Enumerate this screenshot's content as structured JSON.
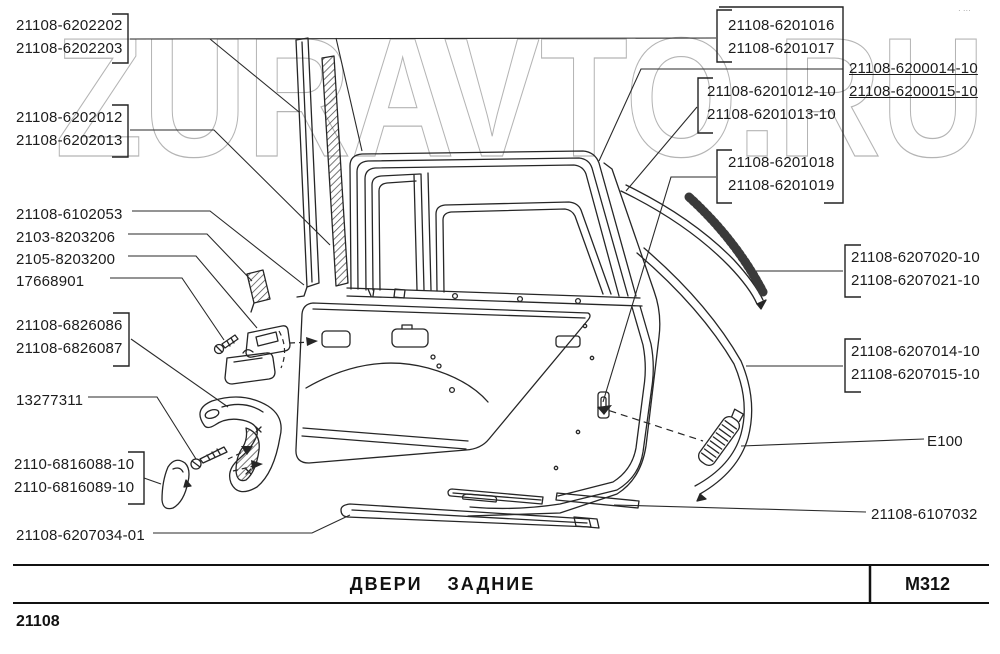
{
  "watermark": {
    "text": "ZURAVTO.RU",
    "color": "#b4b4b4"
  },
  "corner_mark": "· ···",
  "footer": {
    "title": "ДВЕРИ ЗАДНИЕ",
    "code": "M312",
    "model": "21108"
  },
  "labels": {
    "p6202202": {
      "line1": "21108-6202202",
      "line2": "21108-6202203"
    },
    "p6202012": {
      "line1": "21108-6202012",
      "line2": "21108-6202013"
    },
    "s6102053": "21108-6102053",
    "s2103": "2103-8203206",
    "s2105": "2105-8203200",
    "s17668901": "17668901",
    "p6826086": {
      "line1": "21108-6826086",
      "line2": "21108-6826087"
    },
    "s13277311": "13277311",
    "p6816088": {
      "line1": "2110-6816088-10",
      "line2": "2110-6816089-10"
    },
    "s6207034": "21108-6207034-01",
    "p6201016": {
      "line1": "21108-6201016",
      "line2": "21108-6201017"
    },
    "p6201012": {
      "line1": "21108-6201012-10",
      "line2": "21108-6201013-10"
    },
    "p6200014": {
      "line1": "21108-6200014-10",
      "line2": "21108-6200015-10"
    },
    "p6201018": {
      "line1": "21108-6201018",
      "line2": "21108-6201019"
    },
    "p6207020": {
      "line1": "21108-6207020-10",
      "line2": "21108-6207021-10"
    },
    "p6207014": {
      "line1": "21108-6207014-10",
      "line2": "21108-6207015-10"
    },
    "sE100": "E100",
    "s6107032": "21108-6107032"
  }
}
